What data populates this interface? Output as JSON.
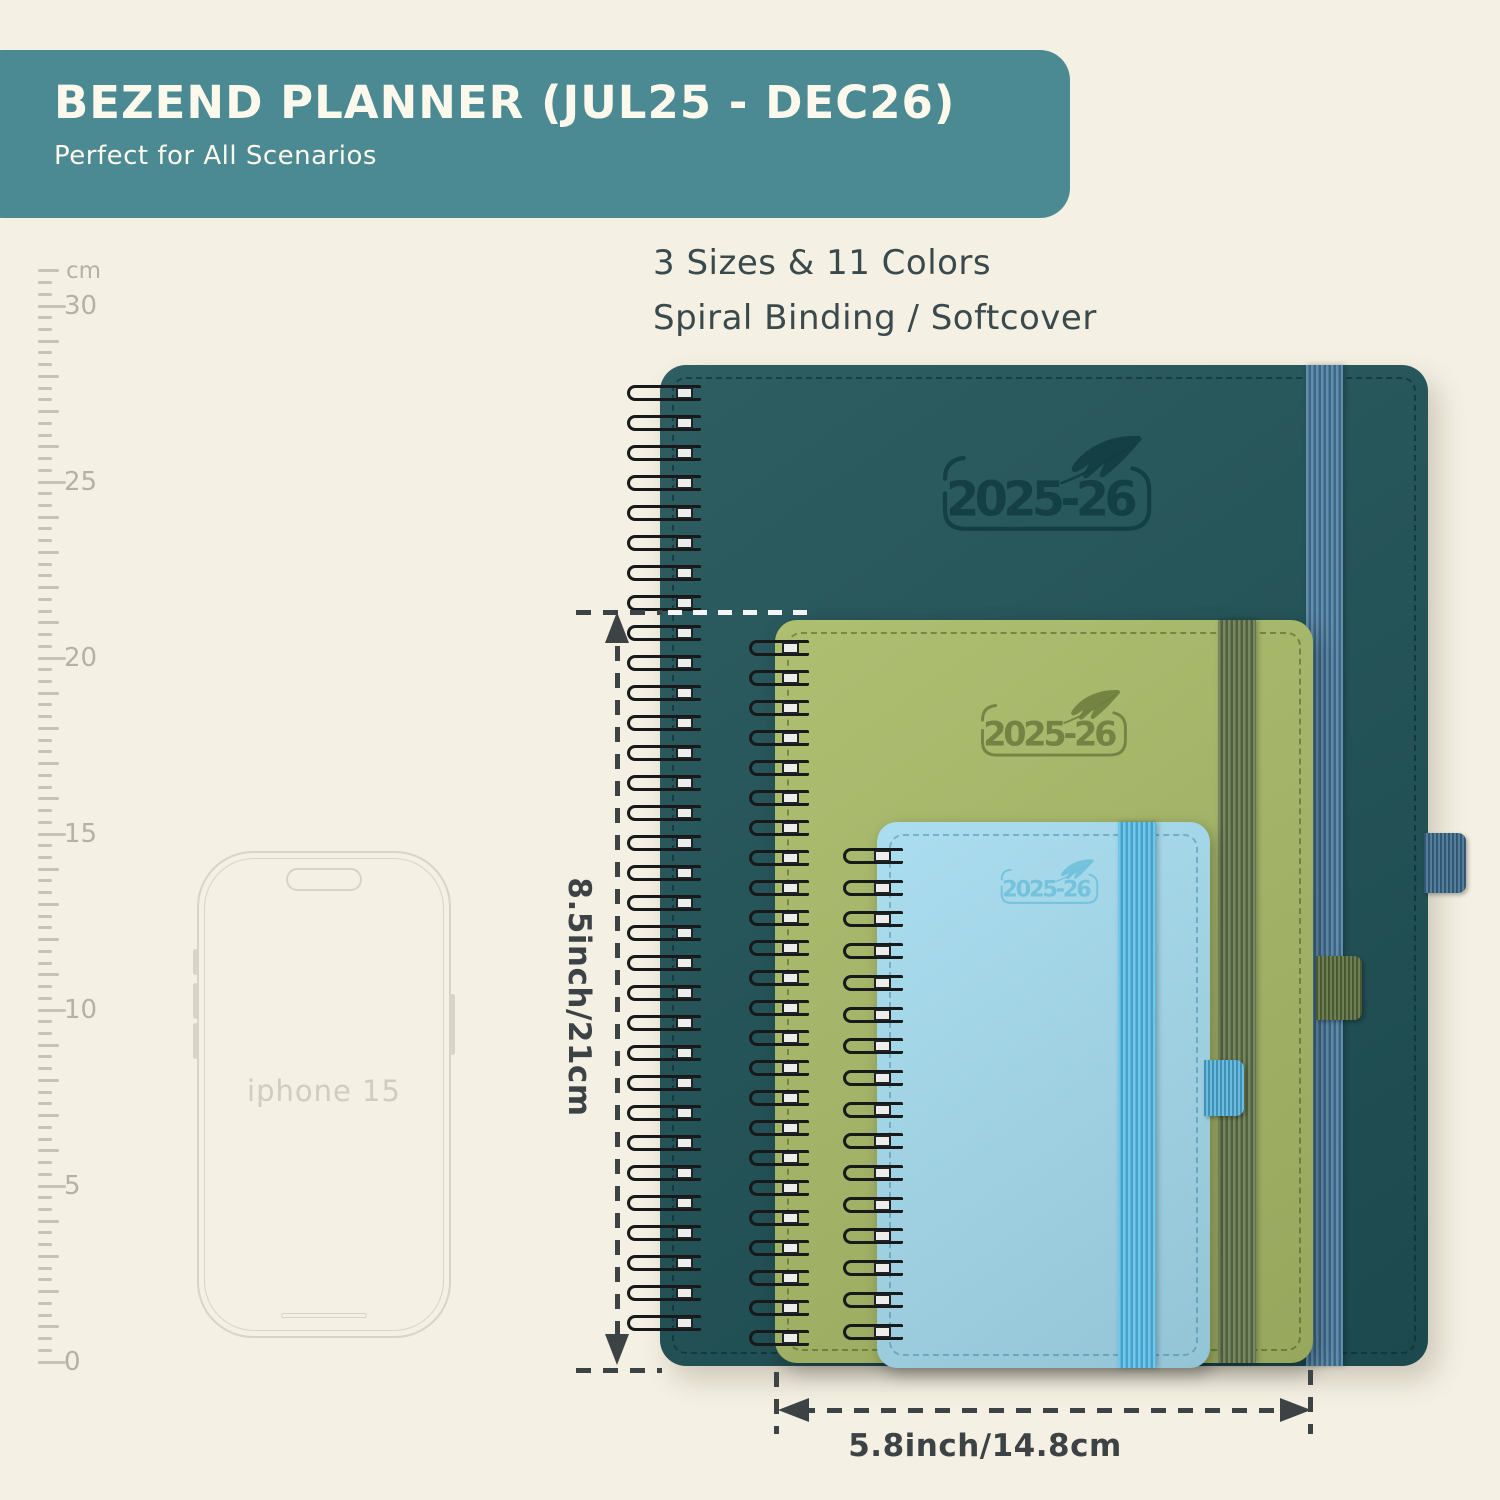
{
  "banner": {
    "title": "BEZEND PLANNER (JUL25 - DEC26)",
    "subtitle": "Perfect for All Scenarios"
  },
  "features": {
    "line1": "3 Sizes & 11 Colors",
    "line2": "Spiral Binding / Softcover"
  },
  "ruler": {
    "unit": "cm",
    "labeled_marks": [
      30,
      25,
      20,
      15,
      10,
      5,
      0
    ]
  },
  "phone": {
    "label": "iphone 15"
  },
  "planners": [
    {
      "name": "large-planner",
      "year_label": "2025-26",
      "cover_color": "#1e5156",
      "band_color": "#46789c",
      "pen_loop_color": "#3f6d8f",
      "emboss_color": "#123d43",
      "stitch_color": "rgba(8,40,46,0.55)"
    },
    {
      "name": "medium-planner",
      "year_label": "2025-26",
      "cover_color": "#a8ba67",
      "band_color": "#5e7145",
      "pen_loop_color": "#5c6e3f",
      "emboss_color": "#6f7e3f",
      "stitch_color": "rgba(60,70,20,0.45)"
    },
    {
      "name": "small-planner",
      "year_label": "2025-26",
      "cover_color": "#a4dbee",
      "band_color": "#54bce8",
      "pen_loop_color": "#55b4dd",
      "emboss_color": "#6fc0da",
      "stitch_color": "rgba(30,100,130,0.35)"
    }
  ],
  "dimensions": {
    "height_label": "8.5inch/21cm",
    "width_label": "5.8inch/14.8cm"
  },
  "colors": {
    "background": "#f4f0e3",
    "banner_bg": "#4b8a93",
    "banner_text": "#fcf8ec",
    "feature_text": "#3a4a4c",
    "dimension_color": "#3d4245",
    "ruler_color": "#c7c3b8",
    "ruler_label_color": "#b5b1a6",
    "phone_color": "#d8d4c8",
    "phone_label_color": "#d0ccbf",
    "coil_color": "#17191b"
  }
}
